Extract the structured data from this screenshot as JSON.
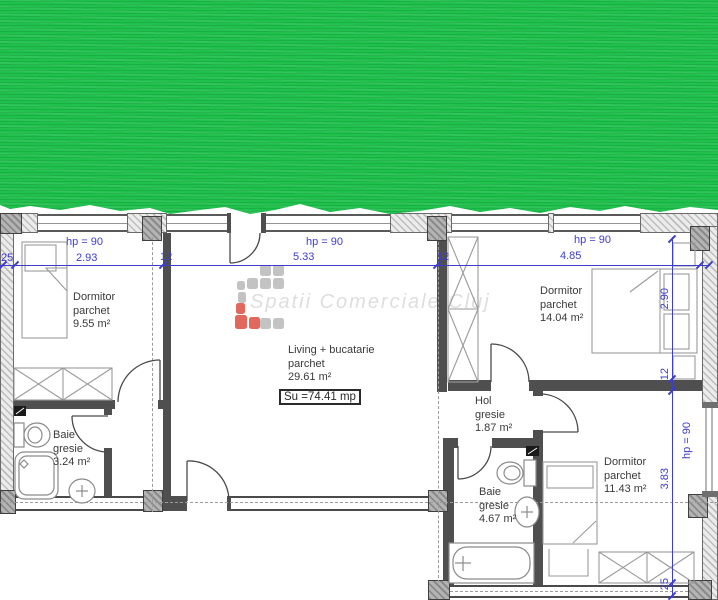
{
  "redaction": {
    "color_primary": "#1fc04c",
    "color_streak": "#15aa3e"
  },
  "watermark": {
    "text": "Spatii Comerciale Cluj",
    "logo_gray": "#c3c3c3",
    "logo_red": "#e2675d"
  },
  "rooms": {
    "dormitor1": {
      "name": "Dormitor",
      "finish": "parchet",
      "area": "9.55 m²"
    },
    "living": {
      "name": "Living + bucatarie",
      "finish": "parchet",
      "area": "29.61 m²"
    },
    "dormitor2": {
      "name": "Dormitor",
      "finish": "parchet",
      "area": "14.04 m²"
    },
    "hol": {
      "name": "Hol",
      "finish": "gresie",
      "area": "1.87 m²"
    },
    "baie1": {
      "name": "Baie",
      "finish": "gresie",
      "area": "3.24 m²"
    },
    "baie2": {
      "name": "Baie",
      "finish": "gresie",
      "area": "4.67 m²"
    },
    "dormitor3": {
      "name": "Dormitor",
      "finish": "parchet",
      "area": "11.43 m²"
    }
  },
  "total_area_label": "Su =74.41 mp",
  "dims": {
    "h": [
      "25",
      "2.93",
      "12",
      "5.33",
      "12",
      "4.85"
    ],
    "v": [
      "2.90",
      "12",
      "3.83",
      "25"
    ],
    "parapet": "hp = 90",
    "color": "#3d3dcb"
  }
}
